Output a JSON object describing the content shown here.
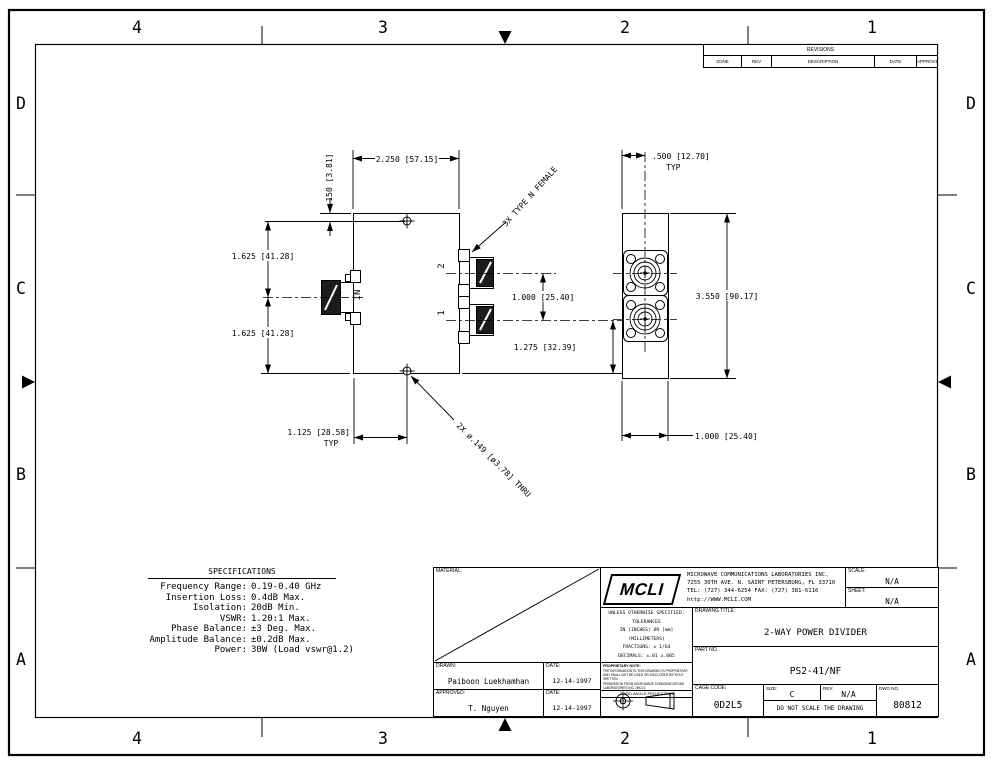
{
  "page": {
    "background": "#ffffff",
    "ink": "#000000"
  },
  "zones": {
    "top": [
      "4",
      "3",
      "2",
      "1"
    ],
    "bottom": [
      "4",
      "3",
      "2",
      "1"
    ],
    "left": [
      "D",
      "C",
      "B",
      "A"
    ],
    "right": [
      "D",
      "C",
      "B",
      "A"
    ]
  },
  "revisions": {
    "title": "REVISIONS",
    "cols": [
      "ZONE",
      "REV",
      "DESCRIPTION",
      "DATE",
      "APPROVED"
    ]
  },
  "front_view": {
    "dim_width": "2.250 [57.15]",
    "dim_top_hole": ".150 [3.81]",
    "dim_upper_half": "1.625 [41.28]",
    "dim_lower_half": "1.625 [41.28]",
    "label_in": "IN",
    "label_port2": "2",
    "label_port1": "1",
    "note_connectors": "3X TYPE N FEMALE",
    "dim_port_spacing": "1.000 [25.40]",
    "dim_port1_to_edge": "1.275 [32.39]",
    "dim_hole_offset": "1.125 [28.58]",
    "dim_hole_offset_typ": "TYP",
    "note_holes": "2X ø.149 [ø3.78] THRU"
  },
  "side_view": {
    "dim_center_offset": ".500 [12.70]",
    "dim_center_offset_typ": "TYP",
    "dim_height": "3.550 [90.17]",
    "dim_width": "1.000 [25.40]"
  },
  "specs": {
    "title": "SPECIFICATIONS",
    "rows": [
      {
        "label": "Frequency Range:",
        "value": "0.19-0.40 GHz"
      },
      {
        "label": "Insertion Loss:",
        "value": "0.4dB Max."
      },
      {
        "label": "Isolation:",
        "value": "20dB Min."
      },
      {
        "label": "VSWR:",
        "value": "1.20:1 Max."
      },
      {
        "label": "Phase Balance:",
        "value": "±3 Deg. Max."
      },
      {
        "label": "Amplitude Balance:",
        "value": "±0.2dB Max."
      },
      {
        "label": "Power:",
        "value": "30W (Load vswr@1.2)"
      }
    ]
  },
  "title_block": {
    "material_label": "MATERIAL:",
    "drawn_label": "DRAWN:",
    "drawn_name": "Paiboon Luekhamhan",
    "drawn_date_label": "DATE:",
    "drawn_date": "12-14-1997",
    "approved_label": "APPROVED:",
    "approved_name": "T. Nguyen",
    "approved_date_label": "DATE:",
    "approved_date": "12-14-1997",
    "logo": "MCLI",
    "company_lines": [
      "MICROWAVE COMMUNICATIONS LABORATORIES INC.",
      "7255 30TH AVE. N. SAINT PETERSBURG, FL 33710",
      "TEL: (727) 344-6254  FAX: (727) 381-6116",
      "http://WWW.MCLI.COM"
    ],
    "scale_label": "SCALE:",
    "scale_value": "N/A",
    "sheet_label": "SHEET:",
    "sheet_value": "N/A",
    "tolerances_lines": [
      "UNLESS OTHERWISE SPECIFIED:",
      "TOLERANCES",
      "IN (INCHES) OR [mm] (MILLIMETERS)",
      "FRACTIONS: ± 1/64",
      "DECIMALS: ±.01 ±.005",
      "ANGLE: ±1/2°"
    ],
    "proprietary_title": "PROPRIETARY NOTE:",
    "proprietary_lines": [
      "THE INFORMATION IN THIS DRAWING IS PROPRIETARY",
      "AND SHALL NOT BE USED OR DISCLOSED WITHOUT WRITTEN",
      "PERMISSION FROM MICROWAVE COMMUNICATIONS",
      "LABORATORIES INC. (MCLI)"
    ],
    "projection_label": "THIRD ANGLE PROJECTION",
    "drawing_title_label": "DRAWING TITLE:",
    "drawing_title": "2-WAY POWER DIVIDER",
    "part_no_label": "PART NO.",
    "part_no": "PS2-41/NF",
    "cage_code_label": "CAGE CODE:",
    "cage_code": "0D2L5",
    "size_label": "SIZE:",
    "size_value": "C",
    "rev_label": "REV:",
    "rev_value": "N/A",
    "dwg_no_label": "DWG NO.",
    "dwg_no": "80812",
    "no_scale_note": "DO NOT SCALE THE DRAWING"
  }
}
